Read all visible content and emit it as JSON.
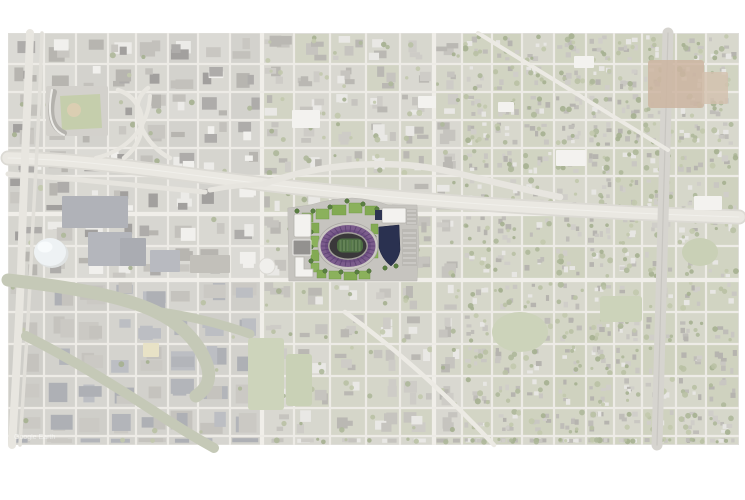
{
  "page": {
    "bg": "#ffffff",
    "width": 745,
    "height": 500
  },
  "map": {
    "x": 8,
    "y": 33,
    "w": 731,
    "h": 412,
    "base": "#deddd8",
    "watermark": "Google Earth",
    "watermark_color": "#ffffff"
  },
  "grid": {
    "xs": [
      8,
      44,
      76,
      108,
      136,
      168,
      198,
      230,
      262,
      294,
      330,
      366,
      400,
      434,
      462,
      492,
      522,
      554,
      586,
      614,
      642,
      676,
      706,
      739
    ],
    "ys": [
      33,
      64,
      92,
      120,
      148,
      176,
      214,
      246,
      280,
      312,
      344,
      376,
      408,
      436,
      445
    ],
    "street_color": "#edebe6",
    "street_width": 2.2,
    "major_x": [
      262,
      434,
      612
    ],
    "major_y": [
      214,
      280
    ],
    "major_color": "#f0eee9",
    "major_width": 4.2
  },
  "seed": 7,
  "zones": {
    "block_fill": {
      "downtown": [
        "#dbdad5",
        "#d7d6d1",
        "#d9d8d2",
        "#d3d2cd",
        "#d6d5cf"
      ],
      "industrial": [
        "#d6d5d0",
        "#d2d1cc",
        "#d4d3ce",
        "#cfcec9"
      ],
      "mixed": [
        "#d9d8d1",
        "#d5d6c9",
        "#d7d7ce",
        "#d2d4c4"
      ],
      "residential": [
        "#d3d5c5",
        "#d6d7ca",
        "#cfd2bf",
        "#d8d8cd",
        "#d1d4c2"
      ]
    },
    "building_fill": {
      "downtown": [
        "#c3c1bc",
        "#b7b5b0",
        "#ecebe8",
        "#aeacaa",
        "#c9c7c2",
        "#f1f0ed",
        "#a2a09e"
      ],
      "industrial": [
        "#b3b5ba",
        "#bcbec3",
        "#c5c3be",
        "#aeb0b5",
        "#cbc9c4"
      ],
      "mixed": [
        "#c6c4bf",
        "#ceccc7",
        "#bab8b3",
        "#e9e8e5"
      ],
      "residential": [
        "#c9c7c2",
        "#d0cec9",
        "#bfbdb8",
        "#e7e6e3",
        "#b6b4af"
      ]
    },
    "tree_fill": [
      "#b9c1a4",
      "#aeb89a",
      "#c2c9ad",
      "#a5b090"
    ]
  },
  "features": [
    {
      "t": "path",
      "d": "M8,158 C100,160 190,176 290,187 C410,200 570,212 739,217",
      "s": "#dcdad4",
      "sw": 15
    },
    {
      "t": "path",
      "d": "M8,158 C100,160 190,176 290,187 C410,200 570,212 739,217",
      "s": "#eae8e2",
      "sw": 11.5
    },
    {
      "t": "path",
      "d": "M8,158 C100,160 190,176 290,187 C410,200 570,212 739,217",
      "s": "#f2f1ed",
      "sw": 1,
      "o": 0.8
    },
    {
      "t": "path",
      "d": "M8,174 C70,178 140,186 205,192",
      "s": "#e6e4de",
      "sw": 5
    },
    {
      "t": "path",
      "d": "M210,190 C230,186 246,185 264,184",
      "s": "#e7e5df",
      "sw": 5
    },
    {
      "t": "path",
      "d": "M264,184 C320,163 392,158 452,172 C486,180 520,189 560,197",
      "s": "#e7e5df",
      "sw": 6.5
    },
    {
      "t": "path",
      "d": "M118,90 C148,100 150,138 124,158",
      "s": "#e8e6e0",
      "sw": 4.5
    },
    {
      "t": "path",
      "d": "M148,88 C122,108 148,148 170,158",
      "s": "#e8e6e0",
      "sw": 4.5
    },
    {
      "t": "path",
      "d": "M96,158 C128,150 148,128 150,96",
      "s": "#e8e6e0",
      "sw": 4
    },
    {
      "t": "path",
      "d": "M30,33 C28,100 24,170 22,240 C20,310 16,380 12,445",
      "s": "#e8e6e0",
      "sw": 8
    },
    {
      "t": "path",
      "d": "M42,33 C40,100 36,170 32,240 C30,300 24,380 20,445",
      "s": "#e2e0da",
      "sw": 3.5
    },
    {
      "t": "path",
      "d": "M668,33 L657,445",
      "s": "#d6d4cf",
      "sw": 11
    },
    {
      "t": "path",
      "d": "M668,33 L657,445",
      "s": "#c8c6c1",
      "sw": 1.2
    },
    {
      "t": "path",
      "d": "M478,33 L668,150",
      "s": "#eceae4",
      "sw": 4
    },
    {
      "t": "path",
      "d": "M345,312 C400,352 452,400 494,445",
      "s": "#eceae4",
      "sw": 4.5
    },
    {
      "t": "path",
      "d": "M8,280 C70,287 122,296 154,311 C182,324 198,342 206,362 C212,378 208,388 196,396",
      "s": "#c5c9b7",
      "sw": 13
    },
    {
      "t": "path",
      "d": "M154,311 C190,316 222,324 250,334",
      "s": "#c5c9b7",
      "sw": 9
    },
    {
      "t": "path",
      "d": "M26,336 C70,358 112,384 152,410 C176,426 196,438 214,448",
      "s": "#c5c9b7",
      "sw": 10
    },
    {
      "t": "rect",
      "x": 62,
      "y": 196,
      "w": 66,
      "h": 32,
      "f": "#b0b2b8",
      "rx": 1
    },
    {
      "t": "rect",
      "x": 88,
      "y": 232,
      "w": 44,
      "h": 34,
      "f": "#b4b6bc",
      "rx": 1
    },
    {
      "t": "rect",
      "x": 120,
      "y": 238,
      "w": 26,
      "h": 28,
      "f": "#aaacb2",
      "rx": 1
    },
    {
      "t": "rect",
      "x": 150,
      "y": 250,
      "w": 30,
      "h": 22,
      "f": "#b8bac0",
      "rx": 1
    },
    {
      "t": "rect",
      "x": 190,
      "y": 255,
      "w": 40,
      "h": 18,
      "f": "#c2c0ba",
      "rx": 1
    },
    {
      "t": "rect",
      "x": 143,
      "y": 343,
      "w": 16,
      "h": 14,
      "f": "#e8e2c6",
      "rx": 1
    },
    {
      "t": "rect",
      "x": 648,
      "y": 60,
      "w": 56,
      "h": 48,
      "f": "#ccb5a1",
      "rx": 3,
      "o": 0.85
    },
    {
      "t": "rect",
      "x": 702,
      "y": 72,
      "w": 26,
      "h": 32,
      "f": "#d3c0ae",
      "rx": 2,
      "o": 0.8
    },
    {
      "t": "rect",
      "x": 46,
      "y": 86,
      "w": 62,
      "h": 50,
      "f": "#d3d1cc",
      "rx": 2
    },
    {
      "t": "path",
      "d": "M60,96 L100,94 L102,128 L62,130 Z",
      "f": "#c5ceac"
    },
    {
      "t": "circle",
      "cx": 74,
      "cy": 110,
      "r": 7,
      "f": "#dbceb2"
    },
    {
      "t": "path",
      "d": "M54,92 C48,114 52,128 64,133",
      "s": "#b4b2ad",
      "sw": 6
    },
    {
      "t": "path",
      "d": "M52,90 C47,114 51,130 64,135",
      "s": "#edece8",
      "sw": 2
    },
    {
      "t": "ellipse",
      "cx": 52,
      "cy": 254,
      "rx": 16.5,
      "ry": 14,
      "f": "#dfe2e2"
    },
    {
      "t": "ellipse",
      "cx": 50,
      "cy": 252,
      "rx": 16,
      "ry": 14,
      "f": "#eef2f4"
    },
    {
      "t": "ellipse",
      "cx": 45,
      "cy": 247,
      "rx": 7.5,
      "ry": 5.5,
      "f": "#f8fbfc"
    },
    {
      "t": "rect",
      "x": 292,
      "y": 110,
      "w": 28,
      "h": 18,
      "f": "#f3f2ef",
      "rx": 1
    },
    {
      "t": "rect",
      "x": 556,
      "y": 150,
      "w": 30,
      "h": 16,
      "f": "#f3f2ef",
      "rx": 1
    },
    {
      "t": "rect",
      "x": 694,
      "y": 196,
      "w": 28,
      "h": 14,
      "f": "#f3f2ef",
      "rx": 1
    },
    {
      "t": "rect",
      "x": 418,
      "y": 96,
      "w": 18,
      "h": 12,
      "f": "#f3f2ef",
      "rx": 1
    },
    {
      "t": "rect",
      "x": 498,
      "y": 102,
      "w": 16,
      "h": 10,
      "f": "#f3f2ef",
      "rx": 1
    },
    {
      "t": "rect",
      "x": 574,
      "y": 56,
      "w": 20,
      "h": 12,
      "f": "#f3f2ef",
      "rx": 1
    },
    {
      "t": "rect",
      "x": 248,
      "y": 338,
      "w": 36,
      "h": 72,
      "f": "#cdd4bb",
      "rx": 3
    },
    {
      "t": "rect",
      "x": 286,
      "y": 354,
      "w": 26,
      "h": 52,
      "f": "#c9d1b6",
      "rx": 3
    },
    {
      "t": "ellipse",
      "cx": 520,
      "cy": 332,
      "rx": 28,
      "ry": 20,
      "f": "#ccd3ba"
    },
    {
      "t": "ellipse",
      "cx": 700,
      "cy": 252,
      "rx": 18,
      "ry": 14,
      "f": "#c9d0b6"
    },
    {
      "t": "rect",
      "x": 600,
      "y": 296,
      "w": 42,
      "h": 26,
      "f": "#ccd3ba",
      "rx": 3
    },
    {
      "t": "circle",
      "cx": 267,
      "cy": 266,
      "r": 8,
      "f": "#f0efec",
      "s": "#dcdad5",
      "sw": 1
    }
  ],
  "site": {
    "colors": {
      "ground": "#c6c4bf",
      "lawn": "#83aa53",
      "tree": "#5a7f42",
      "bowl_purple": "#7b5c8c",
      "bowl_dark": "#3a383a",
      "field_green": "#4c6c42",
      "navy_building": "#2a3150",
      "white_building": "#f3f2ef"
    },
    "shapes": [
      {
        "t": "path",
        "d": "M288,208 L310,205 Q330,199 352,198 Q372,199 388,205 L417,205 L419,243 L417,281 L289,281 Z",
        "f": "#c6c4bf",
        "s": "#b9b7b2",
        "sw": 0.5
      },
      {
        "t": "rect",
        "x": 402,
        "y": 229,
        "w": 15,
        "h": 37,
        "f": "#bbb9b4"
      },
      {
        "t": "hatch",
        "x": 403,
        "y": 233,
        "w": 13,
        "h": 31,
        "step": 5,
        "vert": false,
        "s": "#e5e4e1",
        "sw": 0.7
      },
      {
        "t": "rect",
        "x": 406,
        "y": 209,
        "w": 11,
        "h": 16,
        "f": "#bbb9b4"
      },
      {
        "t": "hatch",
        "x": 407,
        "y": 211,
        "w": 9,
        "h": 13,
        "step": 4,
        "vert": false,
        "s": "#e5e4e1",
        "sw": 0.7
      },
      {
        "t": "rect",
        "x": 302,
        "y": 213,
        "w": 11,
        "h": 9,
        "f": "#83aa53",
        "s": "#6e9645",
        "sw": 0.4
      },
      {
        "t": "rect",
        "x": 316,
        "y": 209,
        "w": 13,
        "h": 10,
        "f": "#8bb15c",
        "s": "#6e9645",
        "sw": 0.4
      },
      {
        "t": "rect",
        "x": 332,
        "y": 205,
        "w": 14,
        "h": 10,
        "f": "#83aa53",
        "s": "#6e9645",
        "sw": 0.4
      },
      {
        "t": "rect",
        "x": 349,
        "y": 203,
        "w": 13,
        "h": 10,
        "f": "#8bb15c",
        "s": "#6e9645",
        "sw": 0.4
      },
      {
        "t": "rect",
        "x": 365,
        "y": 206,
        "w": 12,
        "h": 9,
        "f": "#83aa53",
        "s": "#6e9645",
        "sw": 0.4
      },
      {
        "t": "rect",
        "x": 311,
        "y": 223,
        "w": 8,
        "h": 10,
        "f": "#83aa53",
        "s": "#6e9645",
        "sw": 0.4
      },
      {
        "t": "rect",
        "x": 311,
        "y": 236,
        "w": 8,
        "h": 11,
        "f": "#8bb15c",
        "s": "#6e9645",
        "sw": 0.4
      },
      {
        "t": "rect",
        "x": 311,
        "y": 250,
        "w": 8,
        "h": 11,
        "f": "#83aa53",
        "s": "#6e9645",
        "sw": 0.4
      },
      {
        "t": "rect",
        "x": 311,
        "y": 263,
        "w": 8,
        "h": 9,
        "f": "#8bb15c",
        "s": "#6e9645",
        "sw": 0.4
      },
      {
        "t": "rect",
        "x": 371,
        "y": 224,
        "w": 7,
        "h": 10,
        "f": "#83aa53",
        "s": "#6e9645",
        "sw": 0.4
      },
      {
        "t": "rect",
        "x": 371,
        "y": 248,
        "w": 7,
        "h": 10,
        "f": "#8bb15c",
        "s": "#6e9645",
        "sw": 0.4
      },
      {
        "t": "rect",
        "x": 317,
        "y": 270,
        "w": 9,
        "h": 8,
        "f": "#83aa53",
        "s": "#6e9645",
        "sw": 0.4
      },
      {
        "t": "rect",
        "x": 329,
        "y": 271,
        "w": 12,
        "h": 8,
        "f": "#8bb15c",
        "s": "#6e9645",
        "sw": 0.4
      },
      {
        "t": "rect",
        "x": 344,
        "y": 272,
        "w": 13,
        "h": 8,
        "f": "#83aa53",
        "s": "#6e9645",
        "sw": 0.4
      },
      {
        "t": "rect",
        "x": 359,
        "y": 271,
        "w": 11,
        "h": 8,
        "f": "#8bb15c",
        "s": "#6e9645",
        "sw": 0.4
      },
      {
        "t": "trees",
        "r": 2.2,
        "f": "#5a7f42",
        "s": "#47672f",
        "sw": 0.5,
        "pts": [
          [
            313,
            211
          ],
          [
            330,
            207
          ],
          [
            347,
            201
          ],
          [
            363,
            204
          ],
          [
            377,
            209
          ],
          [
            311,
            232
          ],
          [
            311,
            247
          ],
          [
            311,
            261
          ],
          [
            374,
            237
          ],
          [
            374,
            245
          ],
          [
            325,
            271
          ],
          [
            341,
            272
          ],
          [
            357,
            272
          ],
          [
            369,
            271
          ],
          [
            297,
            211
          ],
          [
            299,
            271
          ],
          [
            385,
            268
          ],
          [
            396,
            266
          ]
        ]
      },
      {
        "t": "rect",
        "x": 294,
        "y": 214,
        "w": 17,
        "h": 23,
        "f": "#f3f2ef",
        "s": "#b5b3ae",
        "sw": 0.8,
        "rx": 2
      },
      {
        "t": "rect",
        "x": 293,
        "y": 240,
        "w": 18,
        "h": 15,
        "f": "#93918f",
        "s": "#e8e7e5",
        "sw": 1,
        "rx": 1
      },
      {
        "t": "path",
        "d": "M295,257 L304,257 L304,269 L313,269 L313,277 L295,277 Z",
        "f": "#f3f2ef",
        "s": "#b5b3ae",
        "sw": 0.8
      },
      {
        "t": "rect",
        "x": 382,
        "y": 208,
        "w": 24,
        "h": 15,
        "f": "#f3f2ef",
        "s": "#b5b3ae",
        "sw": 0.8,
        "rx": 1
      },
      {
        "t": "rect",
        "x": 375,
        "y": 210,
        "w": 7,
        "h": 10,
        "f": "#2d3452"
      },
      {
        "t": "path",
        "d": "M379,227 L399,225 L400,250 Q399,259 391,266 Q382,259 379,248 Z",
        "f": "#2a3150",
        "s": "#1f2540",
        "sw": 0.5
      },
      {
        "t": "ellipse",
        "cx": 348,
        "cy": 246,
        "rx": 30,
        "ry": 23.5,
        "f": "#cbc8c3",
        "s": "#a8a6a1",
        "sw": 0.7
      },
      {
        "t": "ellipse",
        "cx": 348,
        "cy": 246,
        "rx": 27.5,
        "ry": 21,
        "f": "#7b5c8c"
      },
      {
        "t": "ellipse",
        "cx": 348,
        "cy": 246,
        "rx": 23,
        "ry": 16.5,
        "f": "#6e4f82"
      },
      {
        "t": "spokes",
        "cx": 348,
        "cy": 246,
        "rx": 27.2,
        "ry": 20.8,
        "r0": 0.56,
        "n": 30,
        "s": "#5a4070",
        "sw": 0.9,
        "o": 0.85
      },
      {
        "t": "ellipse",
        "cx": 348,
        "cy": 246,
        "rx": 20,
        "ry": 14,
        "f": "#a29f9a"
      },
      {
        "t": "ellipse",
        "cx": 348,
        "cy": 246,
        "rx": 18.5,
        "ry": 12.5,
        "f": "#3a383a"
      },
      {
        "t": "rect",
        "x": 337,
        "y": 238.5,
        "w": 26,
        "h": 14,
        "rx": 5.5,
        "f": "#4c6c42"
      },
      {
        "t": "hatch",
        "x": 340,
        "y": 240,
        "w": 20,
        "h": 11,
        "step": 4,
        "vert": true,
        "s": "#587a4a",
        "sw": 2
      },
      {
        "t": "hatch",
        "x": 341,
        "y": 240,
        "w": 18,
        "h": 11,
        "step": 3,
        "vert": true,
        "s": "#ffffff",
        "sw": 0.4,
        "o": 0.35
      }
    ]
  }
}
